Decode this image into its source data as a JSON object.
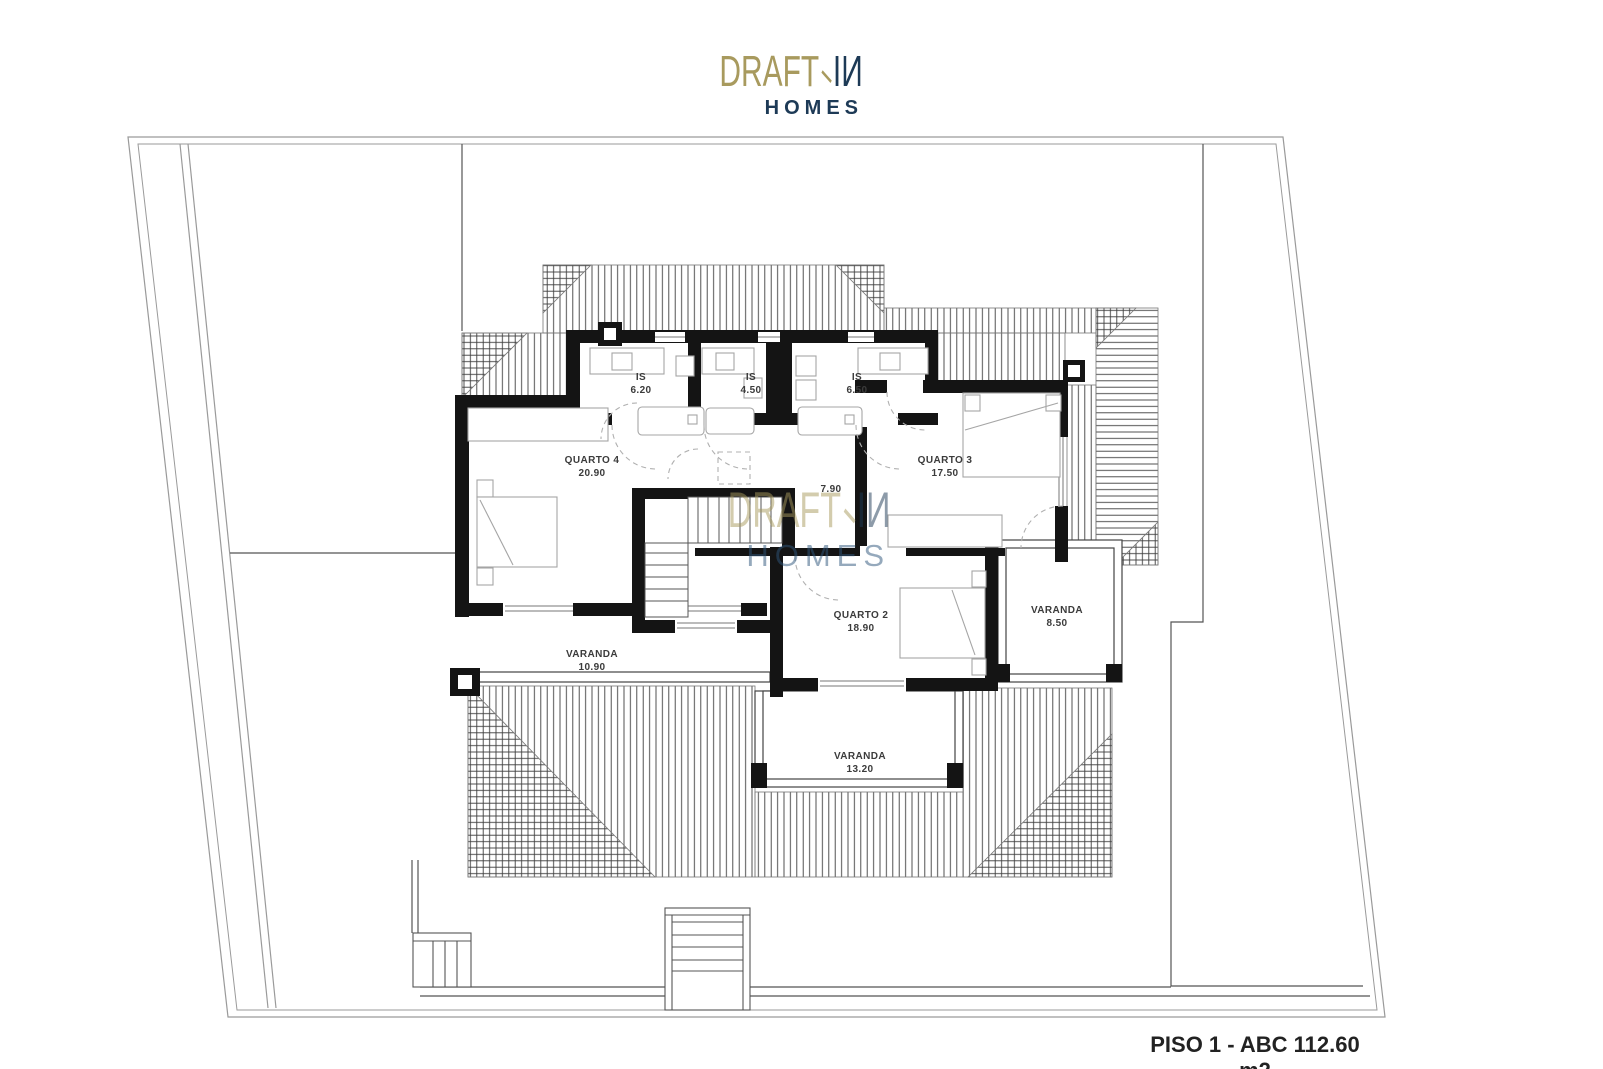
{
  "brand": {
    "word1": "DRAFT",
    "word2": "IИ",
    "sub": "HOMES",
    "gold": "#a89a5e",
    "navy": "#1d3a56"
  },
  "watermark": {
    "word1": "DRAFT",
    "word2": "IИ",
    "sub": "HOMES"
  },
  "plan": {
    "rooms": [
      {
        "name": "IS",
        "area": "6.20"
      },
      {
        "name": "IS",
        "area": "4.50"
      },
      {
        "name": "IS",
        "area": "6.50"
      },
      {
        "name": "QUARTO 4",
        "area": "20.90"
      },
      {
        "name": "QUARTO 3",
        "area": "17.50"
      },
      {
        "name": "",
        "area": "7.90"
      },
      {
        "name": "QUARTO 2",
        "area": "18.90"
      },
      {
        "name": "VARANDA",
        "area": "8.50"
      },
      {
        "name": "VARANDA",
        "area": "10.90"
      },
      {
        "name": "VARANDA",
        "area": "13.20"
      }
    ]
  },
  "footer": {
    "label": "PISO 1 - ABC 112.60 m2"
  }
}
